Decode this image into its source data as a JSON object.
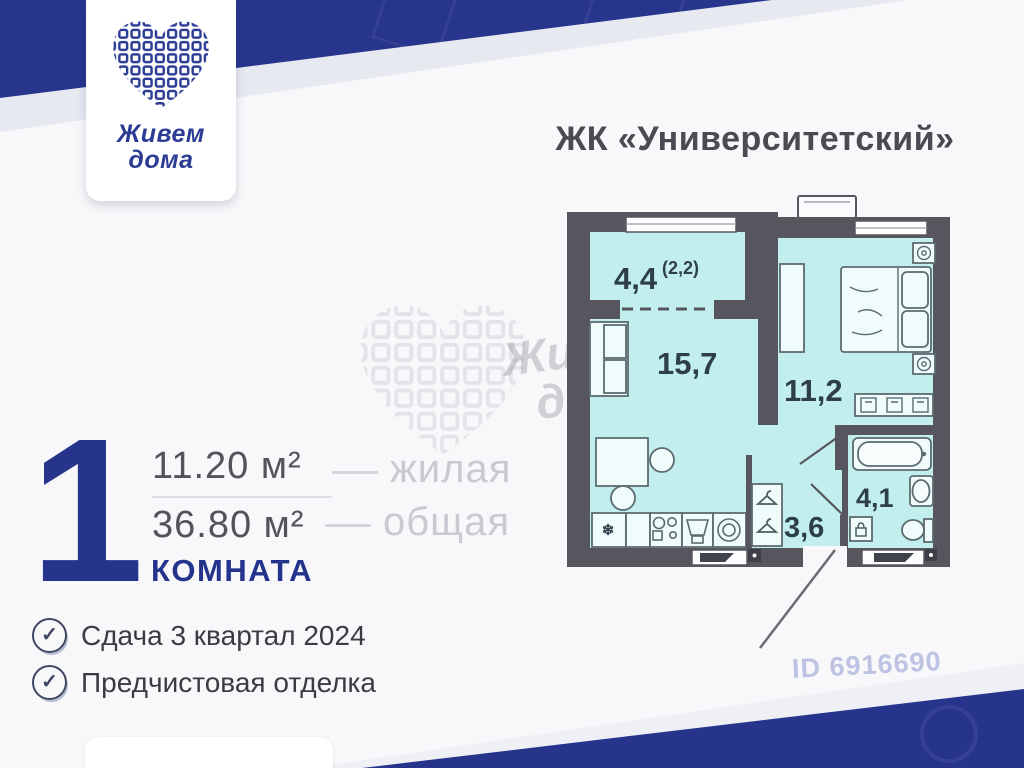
{
  "logo": {
    "line1": "Живем",
    "line2": "дома"
  },
  "header": {
    "title": "ЖК «Университетский»"
  },
  "summary": {
    "rooms_number": "1",
    "living_area": "11.20 м²",
    "living_label": "жилая",
    "total_area": "36.80 м²",
    "total_label": "общая",
    "rooms_word": "КОМНАТА"
  },
  "features": [
    {
      "icon": "check-circle-icon",
      "label": "Сдача 3 квартал 2024"
    },
    {
      "icon": "check-circle-icon",
      "label": "Предчистовая отделка"
    }
  ],
  "plan": {
    "balcony_area": "4,4",
    "balcony_reduced": "(2,2)",
    "living_room": "15,7",
    "bedroom": "11,2",
    "hallway": "3,6",
    "bathroom": "4,1"
  },
  "watermark": {
    "brand_line1": "Живем",
    "brand_line2": "дома",
    "listing_id": "ID 6916690"
  },
  "colors": {
    "accent_blue": "#26348c",
    "wall": "#57565f",
    "room_fill": "#c2eeee"
  }
}
